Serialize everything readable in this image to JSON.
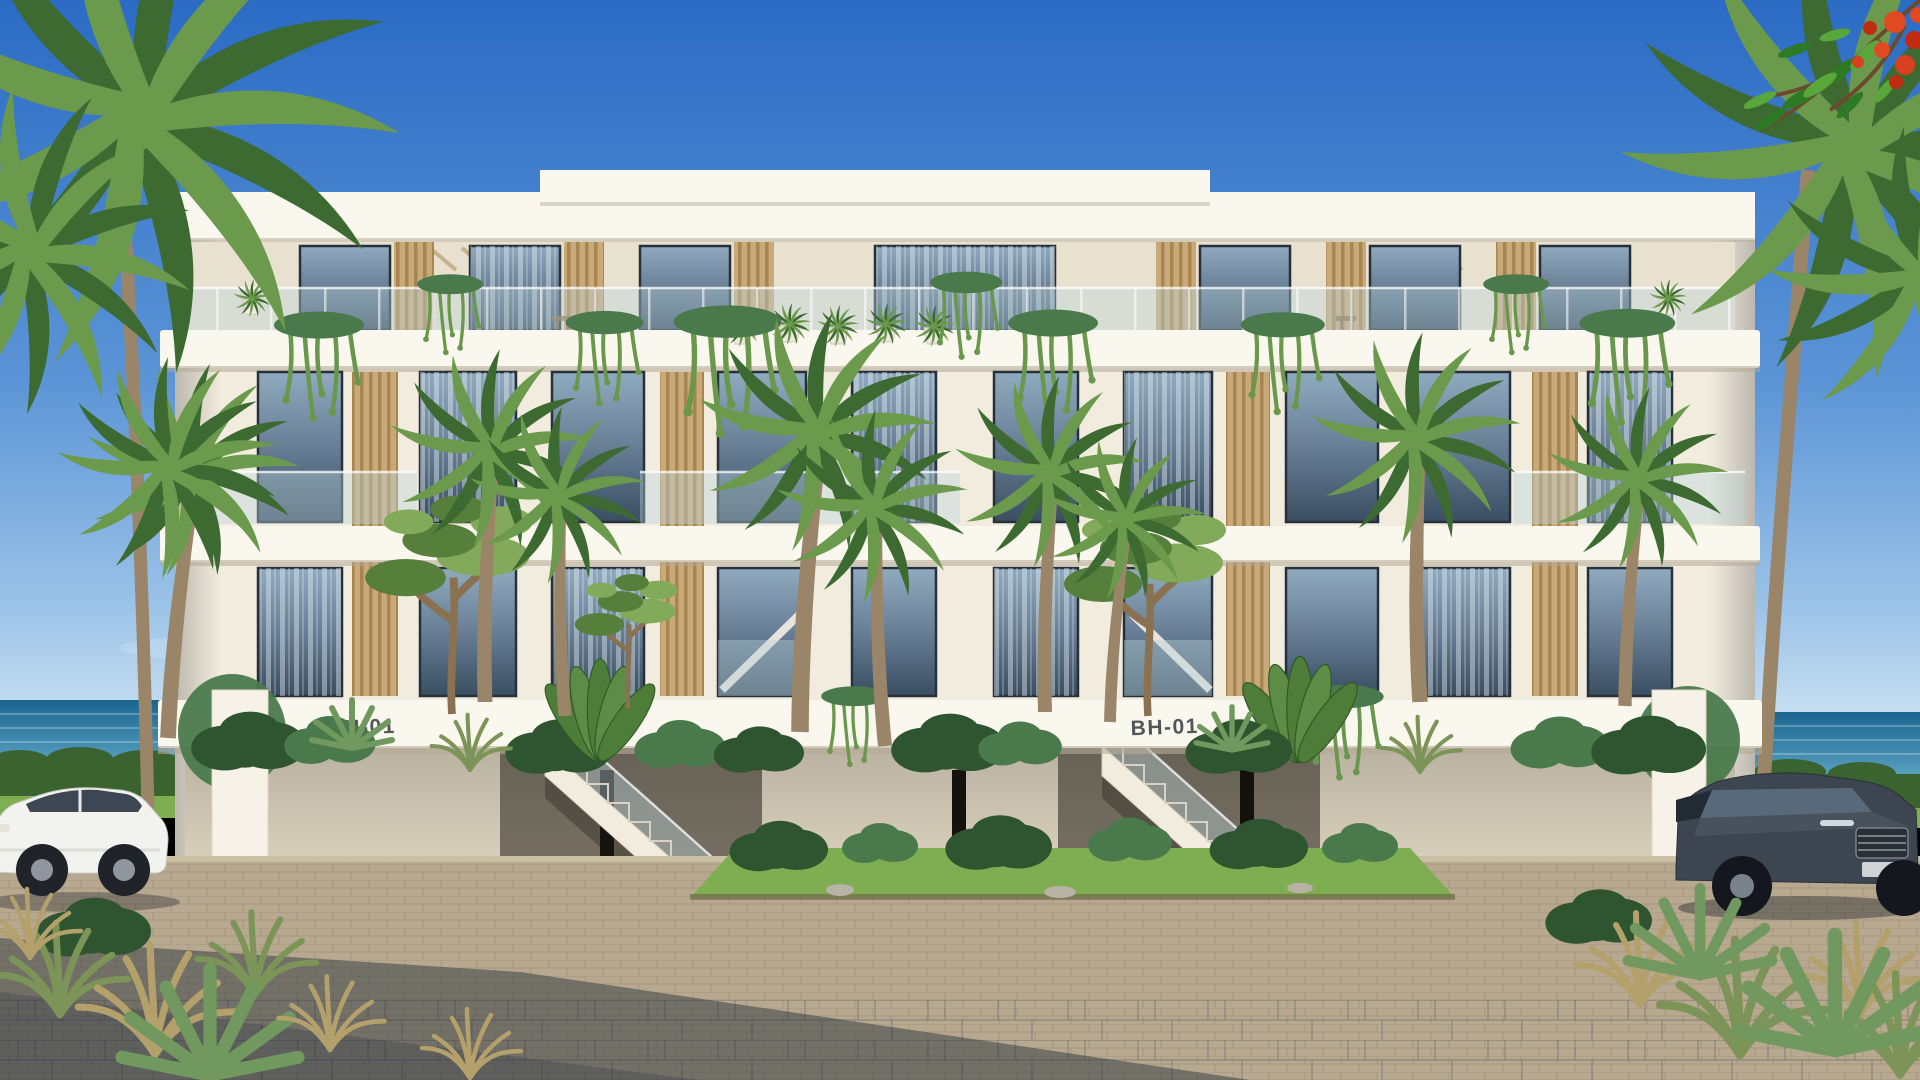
{
  "scene": {
    "description": "Photorealistic exterior render of a modern three-storey beachfront apartment building with wood-slat accents, glass balconies, hanging vines, palm trees, two parked SUVs and a paved forecourt; ocean visible at both sides",
    "labels": {
      "left_fascia": "BH-01",
      "right_fascia": "BH-01"
    },
    "vehicles": {
      "left": "white crossover SUV",
      "right": "dark grey SUV"
    }
  },
  "palette": {
    "sky_top": "#2b6bc4",
    "sky_mid": "#5b94d6",
    "sky_low": "#9cc3e8",
    "sky_horizon": "#d8eaf5",
    "ocean_deep": "#1b6591",
    "ocean_light": "#5fa8c6",
    "hedge": "#3a632f",
    "lawn": "#7fae52",
    "wall": "#f2ecdf",
    "wall_bright": "#faf7ee",
    "wall_shade": "#e9e1d0",
    "ground_wall": "#e3d9c5",
    "slab_shadow": "#b5aa96",
    "wood": "#c9a87a",
    "wood_dark": "#a7854f",
    "glass_top": "#90aabf",
    "glass_mid": "#6c839a",
    "glass_bot": "#3a4e62",
    "frame": "#26303a",
    "rail": "#bcd4dc",
    "palm_light": "#6b9a4d",
    "palm_dark": "#3c6a31",
    "trunk": "#9b8568",
    "pine_light": "#83aa5a",
    "pine_dark": "#567f3b",
    "bush_dark": "#2e5430",
    "bush_light": "#4a7a4c",
    "vine": "#69984d",
    "agave": "#70985f",
    "pave": "#b7a88f",
    "pave_line": "#9c8d74",
    "plaza_line": "#4b5560",
    "shadow": "#222c3a",
    "car_white": "#f2f2ef",
    "car_dark": "#3d4650",
    "flower_red": "#d8401f",
    "text": "#3b4046"
  }
}
